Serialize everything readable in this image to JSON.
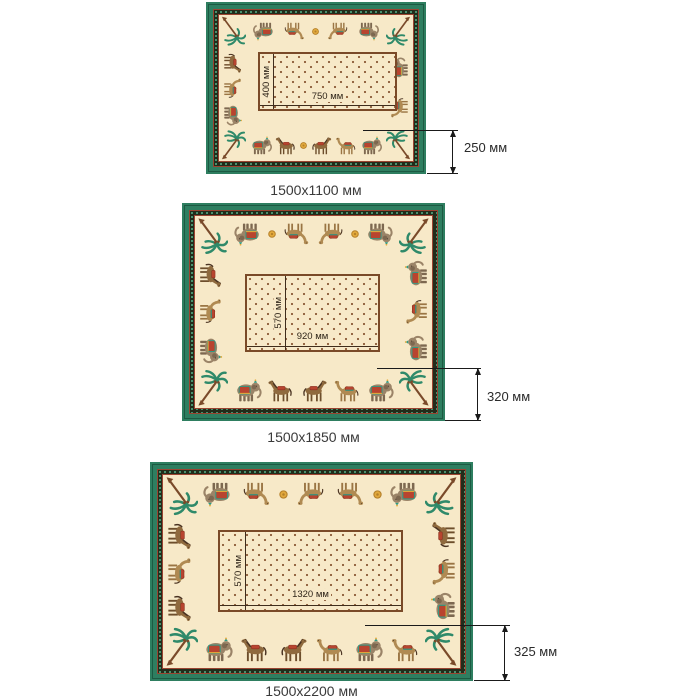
{
  "page": {
    "background": "#ffffff"
  },
  "items": [
    {
      "id": "1500x1100",
      "caption": "1500x1100 мм",
      "center_width_label": "750 мм",
      "center_height_label": "400 мм",
      "border_width_label": "250 мм",
      "border_motifs": {
        "top": [
          "elephant",
          "camel",
          "sun",
          "camel",
          "elephant"
        ],
        "bottom": [
          "elephant",
          "horse",
          "sun",
          "horse",
          "camel",
          "elephant"
        ],
        "left": [
          "horse",
          "camel",
          "elephant"
        ],
        "right": [
          "elephant",
          "camel"
        ]
      }
    },
    {
      "id": "1500x1850",
      "caption": "1500x1850 мм",
      "center_width_label": "920 мм",
      "center_height_label": "570 мм",
      "border_width_label": "320 мм",
      "border_motifs": {
        "top": [
          "elephant",
          "sun",
          "camel",
          "camel",
          "sun",
          "elephant"
        ],
        "bottom": [
          "elephant",
          "horse",
          "horse",
          "camel",
          "elephant"
        ],
        "left": [
          "horse",
          "camel",
          "elephant"
        ],
        "right": [
          "elephant",
          "camel",
          "elephant"
        ]
      }
    },
    {
      "id": "1500x2200",
      "caption": "1500x2200 мм",
      "center_width_label": "1320 мм",
      "center_height_label": "570 мм",
      "border_width_label": "325 мм",
      "border_motifs": {
        "top": [
          "elephant",
          "camel",
          "sun",
          "camel",
          "camel",
          "sun",
          "elephant"
        ],
        "bottom": [
          "elephant",
          "horse",
          "horse",
          "camel",
          "elephant",
          "camel"
        ],
        "left": [
          "horse",
          "camel",
          "horse"
        ],
        "right": [
          "horse",
          "camel",
          "elephant"
        ]
      }
    }
  ],
  "colors": {
    "background": "#ffffff",
    "green": "#2e7e60",
    "green_dark": "#1c5a42",
    "band_bg": "#222c1b",
    "band_dot": "#4fa57e",
    "band_line": "#9a4431",
    "cream": "#f7e9c8",
    "rect_border": "#7a4a28",
    "rect_line": "#3f2d1c",
    "dot": "#8a5a36",
    "dim_line": "#1a1a1a",
    "text": "#3a3a3a",
    "elephant": "#9b8468",
    "elephant_dark": "#7d6850",
    "camel": "#b08a52",
    "camel_leg": "#9a7544",
    "horse": "#8f6a3e",
    "horse_leg": "#6d4e2c",
    "mane": "#4a3322",
    "saddle": "#b8442f",
    "saddle_dark": "#8a2f1f",
    "teal": "#2f9a85",
    "palm": "#2f8a6a",
    "trunk": "#7a4a2a",
    "gold": "#e2a93c",
    "gold_dark": "#b5802a"
  }
}
